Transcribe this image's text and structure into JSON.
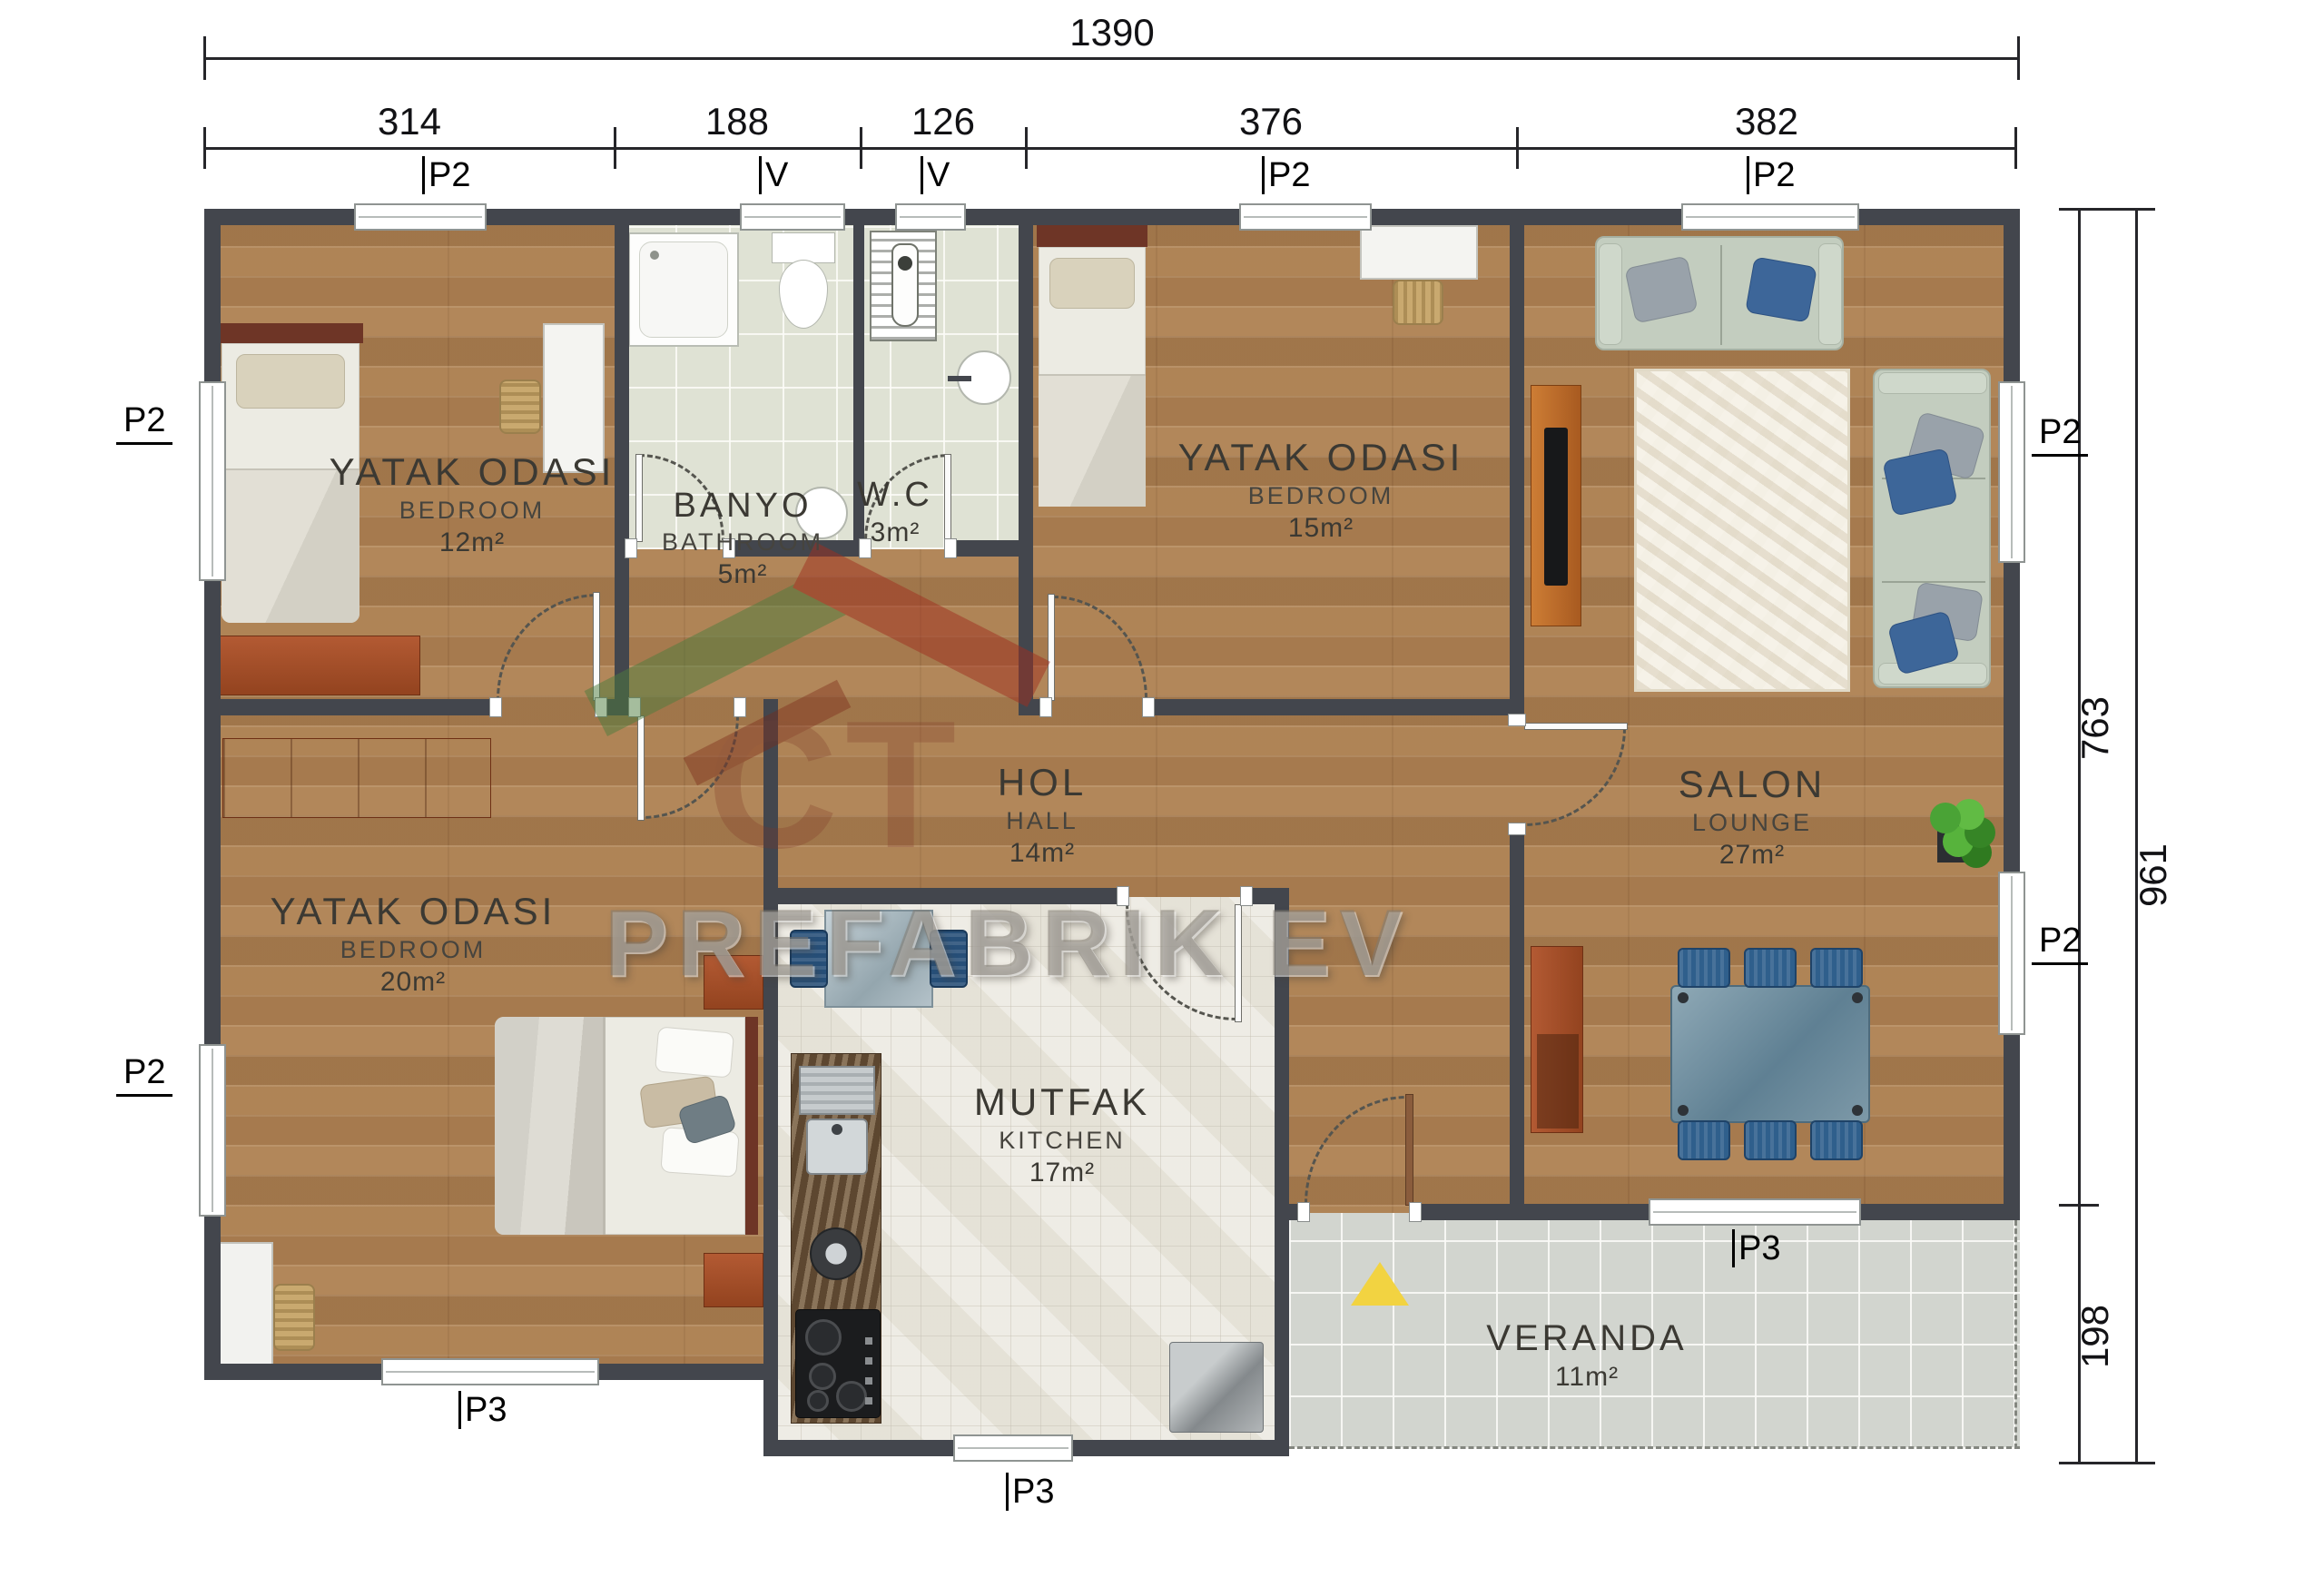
{
  "watermark": {
    "brand": "PREFABRIK EV",
    "logo": "CT"
  },
  "dimensions": {
    "top_total": "1390",
    "top_segments": [
      "314",
      "188",
      "126",
      "376",
      "382"
    ],
    "right_upper": "763",
    "right_total": "961",
    "right_lower": "198"
  },
  "rooms": {
    "bedroom1": {
      "name": "YATAK ODASI",
      "name_en": "BEDROOM",
      "area": "12m²"
    },
    "bathroom": {
      "name": "BANYO",
      "name_en": "BATHROOM",
      "area": "5m²"
    },
    "wc": {
      "name": "W.C",
      "name_en": "",
      "area": "3m²"
    },
    "bedroom2": {
      "name": "YATAK ODASI",
      "name_en": "BEDROOM",
      "area": "15m²"
    },
    "salon": {
      "name": "SALON",
      "name_en": "LOUNGE",
      "area": "27m²"
    },
    "hall": {
      "name": "HOL",
      "name_en": "HALL",
      "area": "14m²"
    },
    "bedroom3": {
      "name": "YATAK ODASI",
      "name_en": "BEDROOM",
      "area": "20m²"
    },
    "kitchen": {
      "name": "MUTFAK",
      "name_en": "KITCHEN",
      "area": "17m²"
    },
    "veranda": {
      "name": "VERANDA",
      "name_en": "",
      "area": "11m²"
    }
  },
  "markers": {
    "top": [
      {
        "text": "P2"
      },
      {
        "text": "V"
      },
      {
        "text": "V"
      },
      {
        "text": "P2"
      },
      {
        "text": "P2"
      }
    ],
    "left": [
      {
        "text": "P2"
      },
      {
        "text": "P2"
      }
    ],
    "right": [
      {
        "text": "P2"
      },
      {
        "text": "P2"
      }
    ],
    "bottom": [
      {
        "text": "P3"
      },
      {
        "text": "P3"
      },
      {
        "text": "P3"
      }
    ]
  }
}
